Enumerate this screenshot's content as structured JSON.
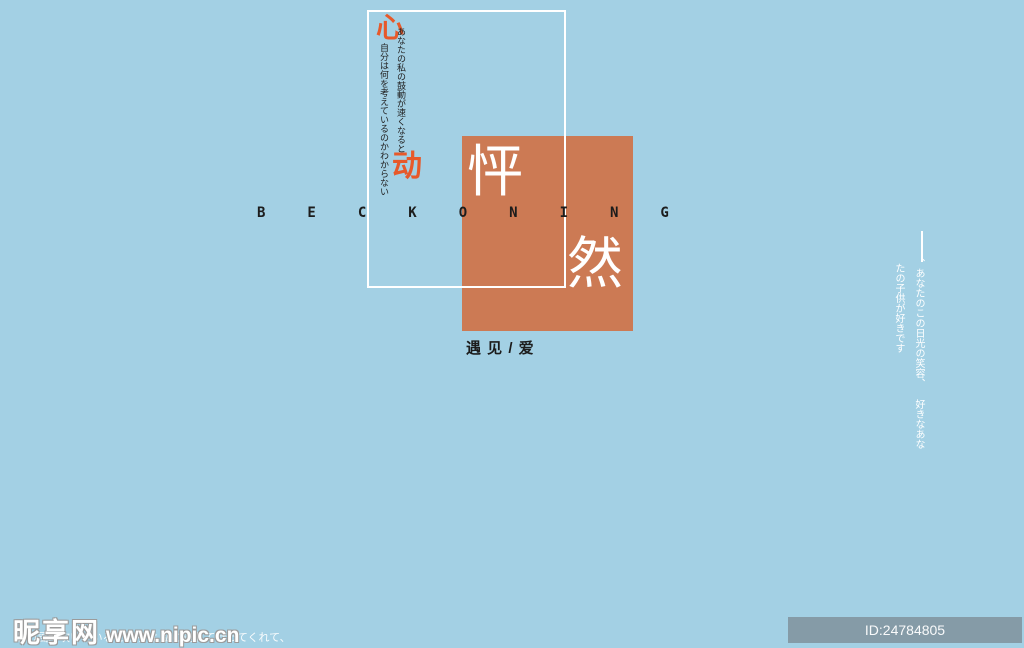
{
  "colors": {
    "background_blue": "#a3d0e4",
    "square_orange": "#cc7a54",
    "accent_orange": "#e7592a",
    "text_white": "#ffffff",
    "text_dark": "#1c1c1c"
  },
  "poster": {
    "heart_char": "心",
    "move_char": "动",
    "peng_char": "怦",
    "ran_char": "然",
    "beckoning": "BECKONING",
    "meet_love": "遇 见 / 爱",
    "left_vtext_col1": "あなたの私の鼓動が速くなると",
    "left_vtext_col2": "自分は何を考えているのかわからない",
    "right_vtext_col1": "、あなたのこの日光の笑容、 好きなあな",
    "right_vtext_col2": "たの子供が好きです"
  },
  "watermark": {
    "site_name": "昵享网",
    "site_url": "www.nipic.cn",
    "caption": "この風が吹いているところは 私に連れて行ってくれて、",
    "id_badge": "ID:24784805 NO:20200420173526488080"
  }
}
